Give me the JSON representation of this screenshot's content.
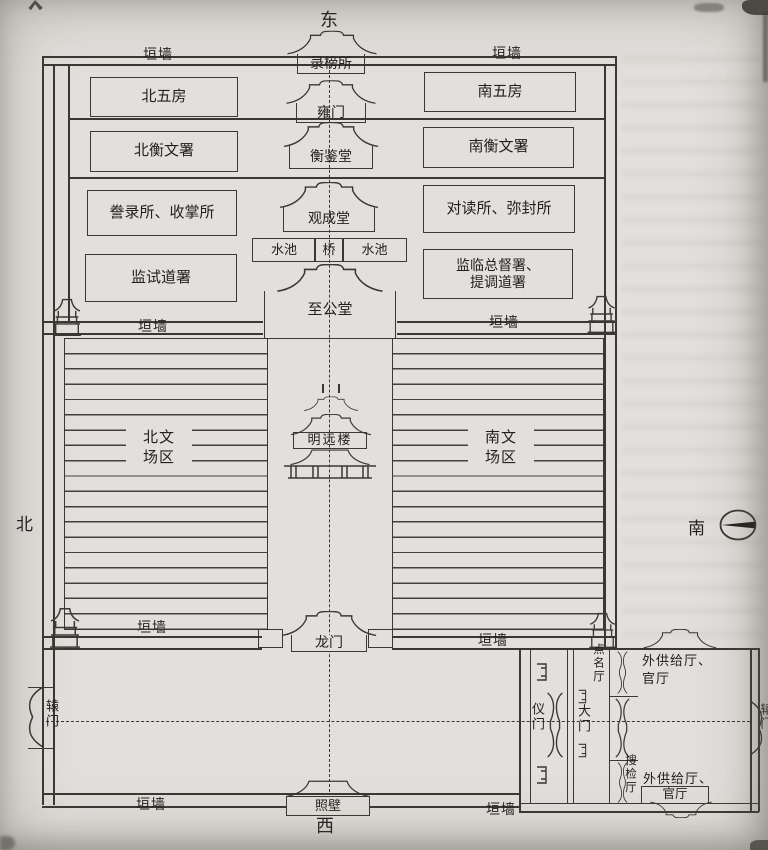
{
  "title": "清代贡院平面示意图",
  "colors": {
    "paper": "#e2e0dc",
    "ink": "#3b3833",
    "text": "#23211e"
  },
  "compass": {
    "east": "东",
    "south": "南",
    "west": "西",
    "north": "北"
  },
  "wall_label": "垣墙",
  "axis_buildings": {
    "record_hall": "录榜所",
    "yong_gate": "雍门",
    "hengjian_hall": "衡鉴堂",
    "guancheng_hall": "观成堂",
    "pool_left": "水池",
    "bridge": "桥",
    "pool_right": "水池",
    "zhigong_hall": "至公堂",
    "mingyuan_tower": "明远楼",
    "dragon_gate": "龙门",
    "screen_wall": "照壁"
  },
  "north_offices": [
    "北五房",
    "北衡文署",
    "誊录所、收掌所",
    "监试道署"
  ],
  "south_offices": [
    "南五房",
    "南衡文署",
    "对读所、弥封所"
  ],
  "supervisor_office": {
    "line1": "监临总督署、",
    "line2": "提调道署"
  },
  "exam_area_north": {
    "line1": "北文",
    "line2": "场区"
  },
  "exam_area_south": {
    "line1": "南文",
    "line2": "场区"
  },
  "gates": {
    "yuan_gate_left": "辕门",
    "yuan_gate_right": "辕门",
    "yi_gate": "仪门",
    "main_gate": "大门"
  },
  "annex": {
    "roll_call_hall": "点名厅",
    "search_hall": "搜检厅",
    "supply_hall_top": {
      "line1": "外供给厅、",
      "line2": "官厅"
    },
    "supply_hall_bottom": {
      "line1": "外供给厅、",
      "line2": "官厅"
    }
  }
}
